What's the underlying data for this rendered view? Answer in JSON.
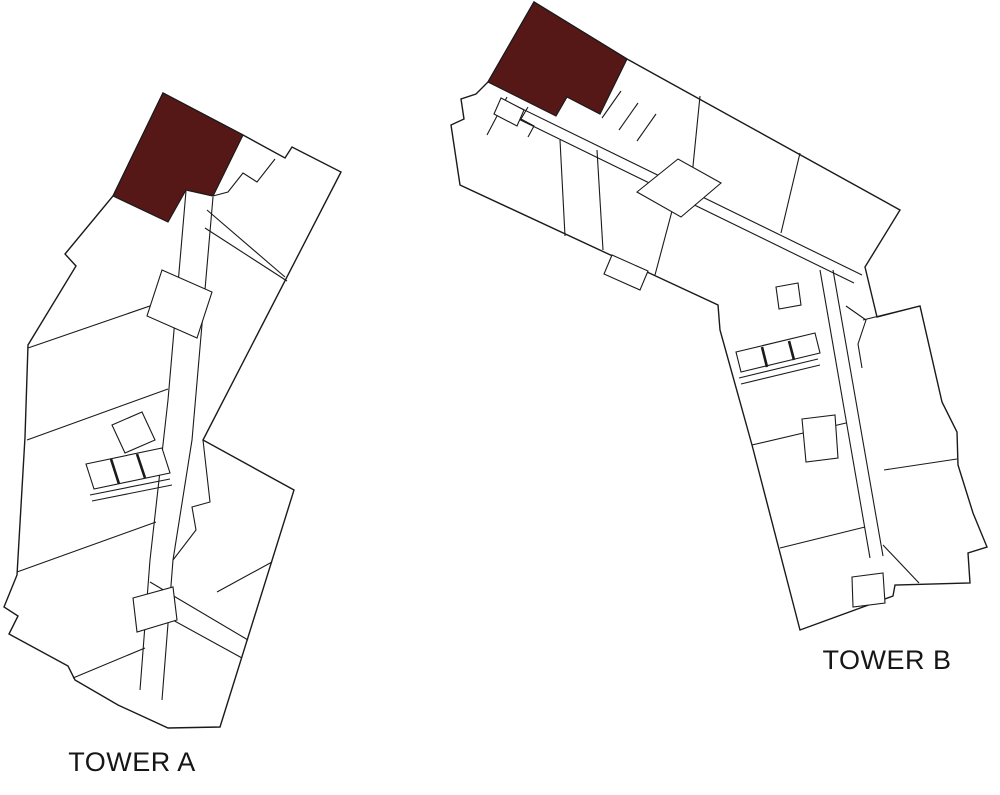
{
  "canvas": {
    "width": 1000,
    "height": 795
  },
  "colors": {
    "background": "#ffffff",
    "line": "#1a1a1a",
    "highlight": "#561816",
    "label_text": "#161616"
  },
  "towers": [
    {
      "id": "tower-a",
      "label": "TOWER A",
      "selected_unit_name": "tower-a-selected-unit",
      "outline": [
        [
          163,
          93
        ],
        [
          243,
          135
        ],
        [
          285,
          158
        ],
        [
          292,
          147
        ],
        [
          341,
          172
        ],
        [
          203,
          440
        ],
        [
          294,
          490
        ],
        [
          220,
          727
        ],
        [
          168,
          728
        ],
        [
          118,
          705
        ],
        [
          75,
          680
        ],
        [
          68,
          666
        ],
        [
          9,
          634
        ],
        [
          18,
          616
        ],
        [
          4,
          607
        ],
        [
          17,
          575
        ],
        [
          25,
          437
        ],
        [
          28,
          345
        ],
        [
          76,
          266
        ],
        [
          65,
          254
        ],
        [
          113,
          196
        ]
      ],
      "selected_unit": [
        [
          163,
          93
        ],
        [
          243,
          135
        ],
        [
          213,
          196
        ],
        [
          186,
          190
        ],
        [
          168,
          222
        ],
        [
          113,
          196
        ]
      ],
      "walls": [
        [
          [
            275,
            159
          ],
          [
            257,
            182
          ],
          [
            243,
            173
          ],
          [
            228,
            192
          ],
          [
            213,
            196
          ]
        ],
        [
          [
            207,
            210
          ],
          [
            285,
            277
          ]
        ],
        [
          [
            205,
            228
          ],
          [
            287,
            281
          ]
        ],
        [
          [
            186,
            191
          ],
          [
            168,
            400
          ],
          [
            150,
            560
          ],
          [
            140,
            690
          ]
        ],
        [
          [
            213,
            197
          ],
          [
            192,
            440
          ],
          [
            173,
            560
          ],
          [
            162,
            700
          ]
        ],
        [
          [
            28,
            348
          ],
          [
            176,
            297
          ]
        ],
        [
          [
            27,
            440
          ],
          [
            168,
            389
          ]
        ],
        [
          [
            17,
            572
          ],
          [
            156,
            522
          ]
        ],
        [
          [
            73,
            678
          ],
          [
            145,
            648
          ]
        ],
        [
          [
            272,
            562
          ],
          [
            217,
            592
          ]
        ],
        [
          [
            150,
            582
          ],
          [
            248,
            640
          ]
        ],
        [
          [
            140,
            602
          ],
          [
            242,
            658
          ]
        ],
        [
          [
            203,
            440
          ],
          [
            210,
            502
          ],
          [
            192,
            507
          ],
          [
            196,
            530
          ],
          [
            173,
            560
          ]
        ],
        [
          [
            90,
            495
          ],
          [
            170,
            479
          ]
        ],
        [
          [
            92,
            501
          ],
          [
            172,
            485
          ]
        ]
      ],
      "white_cores": [
        [
          [
            112,
            425
          ],
          [
            142,
            412
          ],
          [
            155,
            440
          ],
          [
            125,
            453
          ]
        ],
        [
          [
            86,
            464
          ],
          [
            162,
            448
          ],
          [
            170,
            473
          ],
          [
            94,
            489
          ]
        ],
        [
          [
            162,
            270
          ],
          [
            212,
            292
          ],
          [
            197,
            338
          ],
          [
            147,
            316
          ]
        ],
        [
          [
            133,
            598
          ],
          [
            173,
            587
          ],
          [
            177,
            620
          ],
          [
            137,
            632
          ]
        ]
      ],
      "thick_walls": [
        [
          [
            111,
            459
          ],
          [
            119,
            484
          ]
        ],
        [
          [
            137,
            454
          ],
          [
            145,
            478
          ]
        ]
      ]
    },
    {
      "id": "tower-b",
      "label": "TOWER B",
      "selected_unit_name": "tower-b-selected-unit",
      "outline": [
        [
          534,
          2
        ],
        [
          627,
          59
        ],
        [
          900,
          210
        ],
        [
          865,
          267
        ],
        [
          877,
          317
        ],
        [
          920,
          306
        ],
        [
          942,
          402
        ],
        [
          957,
          432
        ],
        [
          958,
          465
        ],
        [
          973,
          513
        ],
        [
          987,
          547
        ],
        [
          968,
          553
        ],
        [
          970,
          583
        ],
        [
          895,
          585
        ],
        [
          893,
          596
        ],
        [
          800,
          630
        ],
        [
          752,
          445
        ],
        [
          720,
          330
        ],
        [
          718,
          305
        ],
        [
          460,
          185
        ],
        [
          451,
          125
        ],
        [
          464,
          119
        ],
        [
          461,
          99
        ],
        [
          476,
          94
        ],
        [
          488,
          82
        ]
      ],
      "selected_unit": [
        [
          534,
          2
        ],
        [
          627,
          59
        ],
        [
          600,
          114
        ],
        [
          567,
          97
        ],
        [
          556,
          116
        ],
        [
          488,
          82
        ]
      ],
      "walls": [
        [
          [
            502,
            99
          ],
          [
            862,
            275
          ]
        ],
        [
          [
            500,
            110
          ],
          [
            854,
            283
          ]
        ],
        [
          [
            507,
            97
          ],
          [
            487,
            135
          ]
        ],
        [
          [
            528,
            107
          ],
          [
            521,
            119
          ],
          [
            534,
            126
          ],
          [
            528,
            137
          ]
        ],
        [
          [
            602,
            118
          ],
          [
            621,
            91
          ]
        ],
        [
          [
            619,
            130
          ],
          [
            638,
            103
          ]
        ],
        [
          [
            637,
            141
          ],
          [
            656,
            114
          ]
        ],
        [
          [
            700,
            96
          ],
          [
            691,
            186
          ]
        ],
        [
          [
            800,
            153
          ],
          [
            781,
            233
          ]
        ],
        [
          [
            560,
            140
          ],
          [
            565,
            236
          ]
        ],
        [
          [
            597,
            150
          ],
          [
            603,
            250
          ]
        ],
        [
          [
            676,
            196
          ],
          [
            655,
            275
          ]
        ],
        [
          [
            846,
            306
          ],
          [
            866,
            320
          ],
          [
            858,
            344
          ],
          [
            862,
            368
          ]
        ],
        [
          [
            863,
            320
          ],
          [
            920,
            306
          ]
        ],
        [
          [
            884,
            470
          ],
          [
            957,
            459
          ]
        ],
        [
          [
            883,
            545
          ],
          [
            919,
            583
          ]
        ],
        [
          [
            752,
            445
          ],
          [
            846,
            423
          ]
        ],
        [
          [
            780,
            548
          ],
          [
            865,
            527
          ]
        ],
        [
          [
            820,
            270
          ],
          [
            870,
            558
          ]
        ],
        [
          [
            833,
            270
          ],
          [
            883,
            556
          ]
        ],
        [
          [
            739,
            378
          ],
          [
            818,
            359
          ]
        ],
        [
          [
            741,
            384
          ],
          [
            820,
            365
          ]
        ]
      ],
      "white_cores": [
        [
          [
            637,
            192
          ],
          [
            678,
            159
          ],
          [
            721,
            183
          ],
          [
            681,
            217
          ]
        ],
        [
          [
            776,
            287
          ],
          [
            798,
            283
          ],
          [
            801,
            305
          ],
          [
            779,
            309
          ]
        ],
        [
          [
            736,
            352
          ],
          [
            815,
            333
          ],
          [
            820,
            353
          ],
          [
            741,
            372
          ]
        ],
        [
          [
            802,
            419
          ],
          [
            835,
            415
          ],
          [
            838,
            458
          ],
          [
            806,
            462
          ]
        ],
        [
          [
            852,
            577
          ],
          [
            883,
            573
          ],
          [
            885,
            603
          ],
          [
            853,
            607
          ]
        ],
        [
          [
            612,
            255
          ],
          [
            648,
            271
          ],
          [
            640,
            290
          ],
          [
            604,
            274
          ]
        ],
        [
          [
            501,
            98
          ],
          [
            524,
            110
          ],
          [
            517,
            126
          ],
          [
            494,
            114
          ]
        ]
      ],
      "thick_walls": [
        [
          [
            762,
            347
          ],
          [
            767,
            367
          ]
        ],
        [
          [
            789,
            341
          ],
          [
            794,
            360
          ]
        ]
      ]
    }
  ]
}
